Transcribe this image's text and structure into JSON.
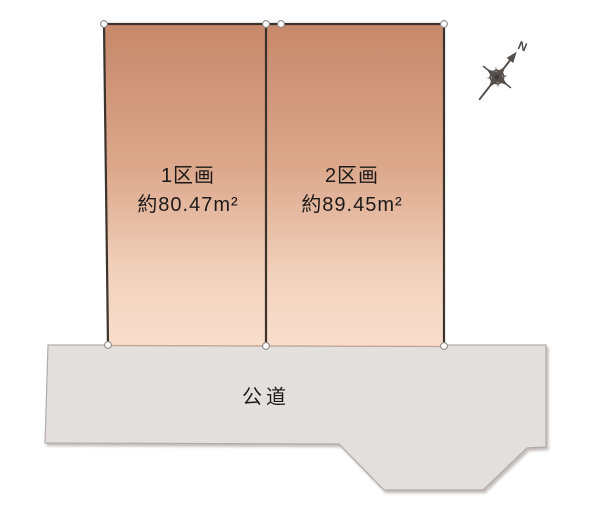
{
  "diagram": {
    "type": "land-plot-layout",
    "plots": [
      {
        "name_label": "1区画",
        "area_label": "約80.47m²"
      },
      {
        "name_label": "2区画",
        "area_label": "約89.45m²"
      }
    ],
    "road": {
      "label": "公道"
    },
    "compass": {
      "north_label": "N"
    },
    "colors": {
      "plot_gradient_top": "#c6886b",
      "plot_gradient_bottom": "#f8decc",
      "plot_outline": "#3b332c",
      "plot_bottom_edge": "#c2a58e",
      "road_fill": "#e3dfdc",
      "road_outline": "#b2adaa",
      "marker_fill": "#ffffff",
      "marker_stroke": "#8f8b88",
      "compass_color": "#55504c",
      "text_color": "#1d1b1a",
      "background": "#ffffff"
    }
  }
}
